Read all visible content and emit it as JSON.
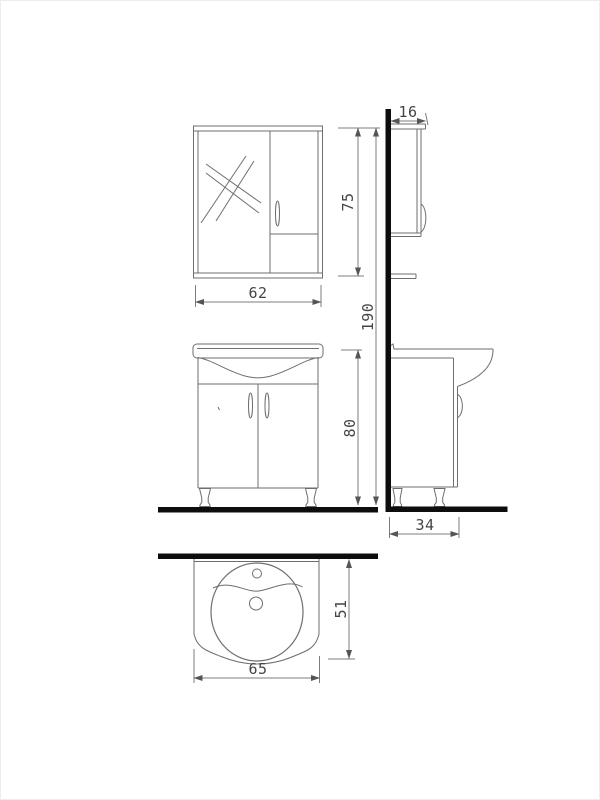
{
  "page": {
    "background_color": "#ffffff",
    "border_color": "#ececec"
  },
  "drawing": {
    "type": "bathroom-furniture-technical-drawing",
    "stroke_color": "#6e6e6e",
    "dimension_line_color": "#7c7c7c",
    "wall_floor_color": "#0d0d0d",
    "label_color": "#454545",
    "views": {
      "front_mirror_cabinet": {
        "width_cm": "62",
        "height_cm": "75"
      },
      "side_mirror_cabinet": {
        "depth_cm": "16"
      },
      "overall": {
        "total_height_cm": "190"
      },
      "front_vanity_cabinet": {
        "height_cm": "80"
      },
      "side_vanity_cabinet": {
        "depth_cm": "34"
      },
      "top_view_basin": {
        "width_cm": "65",
        "depth_cm": "51"
      }
    }
  }
}
